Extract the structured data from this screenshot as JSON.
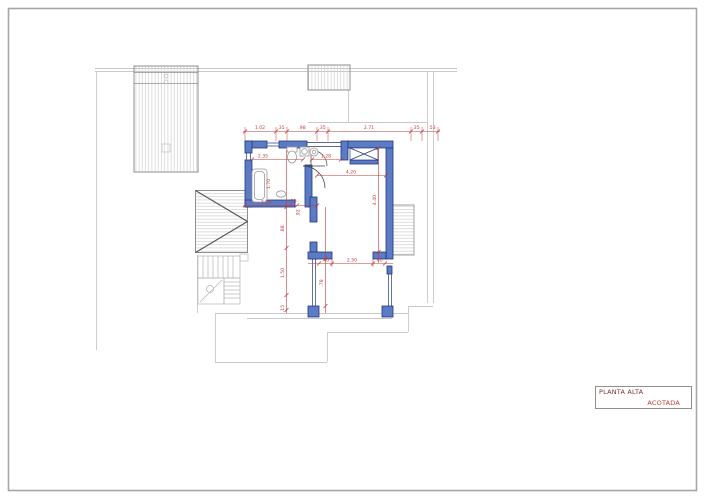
{
  "title_block": {
    "title": "PLANTA ALTA",
    "subtitle": "ACOTADA"
  },
  "colors": {
    "wall_fill": "#5b7cc4",
    "wall_stroke": "#22357d",
    "dimension": "#c23b3b",
    "title": "#7a3030",
    "subtitle": "#c0392b",
    "outline_light": "#c9c9c9",
    "outline_mid": "#8f8f8f",
    "hatch": "#cfcfcf",
    "fixture": "#9a9a9a",
    "border": "#a6a6a6"
  },
  "plan": {
    "dimensions": [
      {
        "label": "1.02",
        "x": 260,
        "y": 129
      },
      {
        "label": ".35",
        "x": 281,
        "y": 129
      },
      {
        "label": ".98",
        "x": 302,
        "y": 129
      },
      {
        "label": ".35",
        "x": 322,
        "y": 129
      },
      {
        "label": "2.71",
        "x": 369,
        "y": 129
      },
      {
        "label": ".35",
        "x": 416,
        "y": 129
      },
      {
        "label": ".53",
        "x": 432,
        "y": 129
      },
      {
        "label": "2.35",
        "x": 263,
        "y": 157.5
      },
      {
        "label": "1.28",
        "x": 326,
        "y": 157.5
      },
      {
        "label": "4.20",
        "x": 351,
        "y": 173.5
      },
      {
        "label": "4.40",
        "x": 376,
        "y": 200,
        "rot": true
      },
      {
        "label": "2.79",
        "x": 266,
        "y": 203.5
      },
      {
        "label": ".15",
        "x": 293,
        "y": 202.5
      },
      {
        "label": ".92",
        "x": 299.5,
        "y": 213,
        "rot": true
      },
      {
        "label": "1.70",
        "x": 270,
        "y": 184,
        "rot": true
      },
      {
        "label": ".88",
        "x": 284,
        "y": 229,
        "rot": true
      },
      {
        "label": "1.50",
        "x": 284,
        "y": 273,
        "rot": true
      },
      {
        "label": ".15",
        "x": 284,
        "y": 308.5,
        "rot": true
      },
      {
        "label": ".78",
        "x": 323,
        "y": 283,
        "rot": true
      },
      {
        "label": ".40",
        "x": 325.5,
        "y": 261.5
      },
      {
        "label": "2.50",
        "x": 352,
        "y": 261.5
      },
      {
        "label": ".40",
        "x": 379,
        "y": 261.5
      }
    ]
  }
}
